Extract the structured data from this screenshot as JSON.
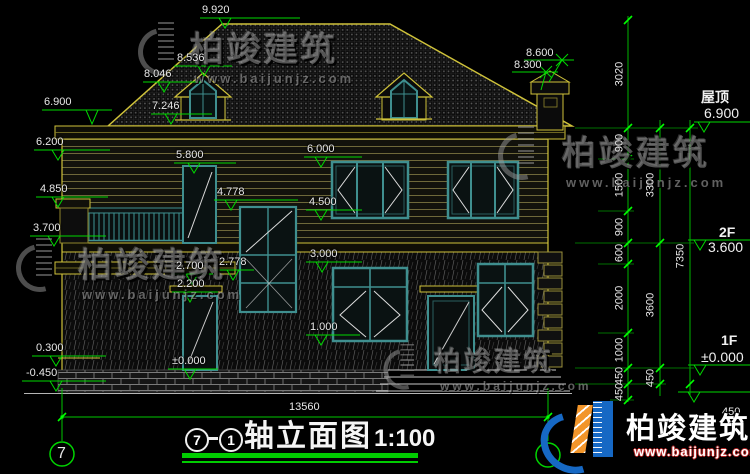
{
  "brand": {
    "name": "柏竣建筑",
    "url": "www.baijunjz.com"
  },
  "title": {
    "axis_left": "7",
    "axis_right": "1",
    "name": "轴立面图",
    "scale": "1:100"
  },
  "axis": {
    "left_bubble": "7",
    "total_width": "13560"
  },
  "floors": [
    {
      "name": "屋顶",
      "elev": "6.900"
    },
    {
      "name": "2F",
      "elev": "3.600"
    },
    {
      "name": "1F",
      "elev": "±0.000"
    }
  ],
  "extra_dim": "450",
  "marks": {
    "peak": "9.920",
    "dormer_ridge": "8.536",
    "dormer_eave": "8.046",
    "dormer_sill": "7.246",
    "chimney_top": "8.600",
    "chimney_cap": "8.300",
    "eave_left": "6.900",
    "beam": "6.200",
    "door2f_top": "5.800",
    "rail_top": "4.850",
    "stair_win_top": "4.778",
    "win2f_top": "6.000",
    "win2f_sill": "4.500",
    "rail_bottom": "3.700",
    "win1f_top": "3.000",
    "porch_top": "2.778",
    "porch_eave": "2.700",
    "lintel": "2.200",
    "win1f_sill": "1.000",
    "floor_zero": "±0.000",
    "plinth": "0.300",
    "ground": "-0.450"
  },
  "chains": {
    "inner": [
      "3020",
      "900",
      "1500",
      "900",
      "600",
      "2000",
      "1000",
      "450",
      "450"
    ],
    "mid": [
      "3300",
      "3600",
      "450"
    ],
    "outer": [
      "7350"
    ]
  }
}
